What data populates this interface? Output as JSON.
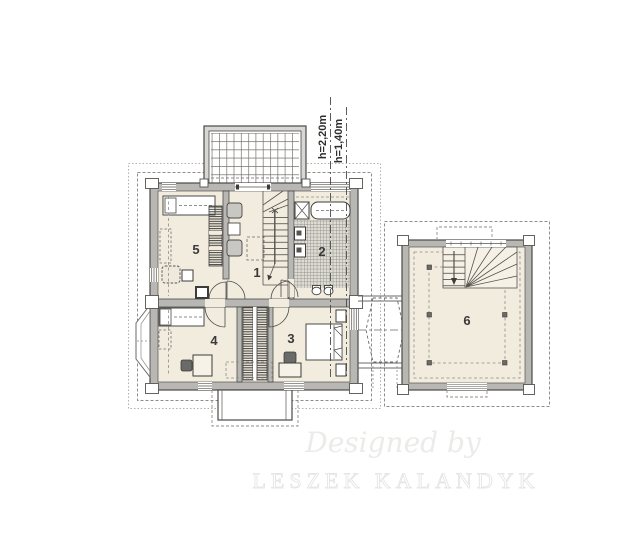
{
  "plan": {
    "rooms": [
      {
        "id": 1,
        "number": "1"
      },
      {
        "id": 2,
        "number": "2"
      },
      {
        "id": 3,
        "number": "3"
      },
      {
        "id": 4,
        "number": "4"
      },
      {
        "id": 5,
        "number": "5"
      },
      {
        "id": 6,
        "number": "6"
      }
    ],
    "height_labels": [
      {
        "text": "h=2,20m"
      },
      {
        "text": "h=1,40m"
      }
    ]
  },
  "watermark": {
    "line1": "Designed by",
    "line2": "LESZEK KALANDYK"
  },
  "colors": {
    "background": "#ffffff",
    "floor": "#f2ecdf",
    "wall_fill": "#b9b7b3",
    "line": "#4a4a48",
    "dashed_gray": "#8f8d89",
    "hatch_dark": "#3c3c3a",
    "tile_gray": "#dfdcd4",
    "watermark_gray": "#e9e9e7"
  }
}
